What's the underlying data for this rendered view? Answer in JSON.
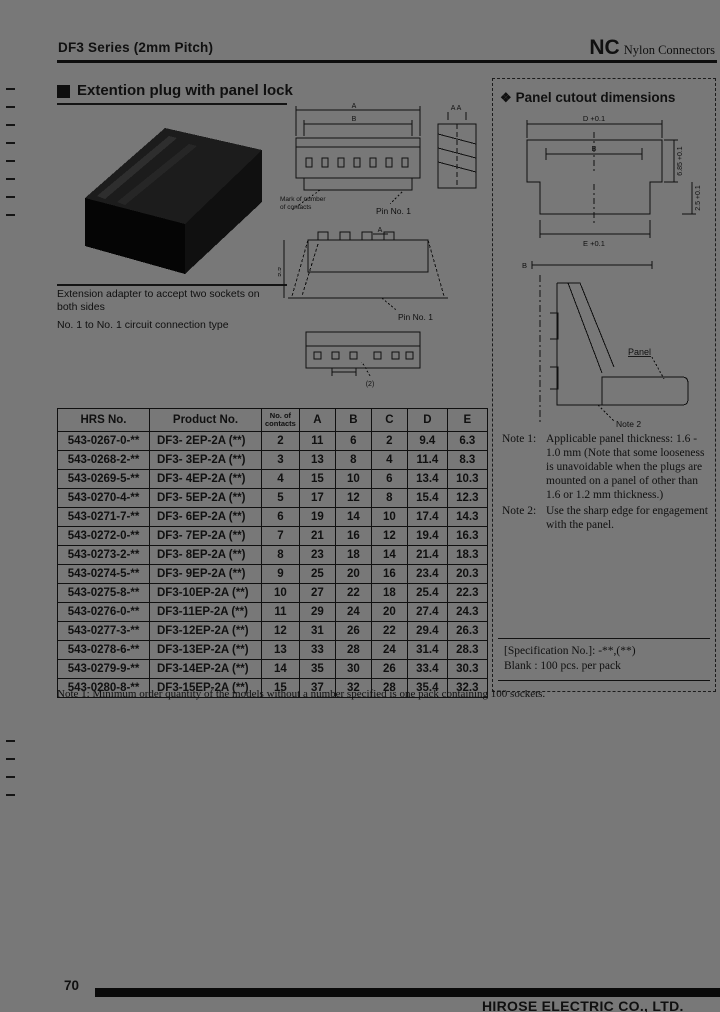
{
  "header": {
    "series": "DF3 Series (2mm Pitch)",
    "brand": "NC",
    "brand_type": "Nylon Connectors"
  },
  "plug_section": {
    "title": "Extention plug with panel lock",
    "caption1": "Extension adapter to accept two sockets on",
    "caption2": "both sides",
    "caption3": "No. 1 to No. 1 circuit connection type"
  },
  "drawings": {
    "dim_a_top": "A",
    "dim_b_top": "B",
    "section_label": "A  A",
    "mark_label1": "Mark of number",
    "mark_label2": "of contacts",
    "pin_label_front": "Pin No. 1",
    "dim_side_height": "9.9",
    "dim_side_a": "A",
    "pin_label_side": "Pin No. 1",
    "dim_bottom": "(2)"
  },
  "panel_section": {
    "bullet": "❖",
    "title": "Panel cutout dimensions",
    "cutout_dim_top": "D +0.1",
    "cutout_dim_inner": "B",
    "cutout_dim_right_upper": "6.85 +0.1",
    "cutout_dim_right_lower": "2.5 +0.1",
    "cutout_dim_bottom": "E +0.1",
    "engage_dim_top": "B",
    "panel_label": "Panel",
    "note2_ref": "Note 2",
    "note1_label": "Note 1:",
    "note1_text": "Applicable panel thickness: 1.6 - 1.0 mm (Note that some looseness is unavoidable when the plugs are mounted on a panel of other than 1.6 or 1.2 mm thickness.)",
    "note2_label": "Note 2:",
    "note2_text": "Use the sharp edge for engagement with the panel.",
    "spec_line1": "[Specification No.]: -**,(**)",
    "spec_line2": "Blank : 100 pcs. per pack"
  },
  "table": {
    "headers": [
      "HRS No.",
      "Product No.",
      "No. of contacts",
      "A",
      "B",
      "C",
      "D",
      "E"
    ],
    "rows": [
      [
        "543-0267-0-**",
        "DF3- 2EP-2A (**)",
        "2",
        "11",
        "6",
        "2",
        "9.4",
        "6.3"
      ],
      [
        "543-0268-2-**",
        "DF3- 3EP-2A (**)",
        "3",
        "13",
        "8",
        "4",
        "11.4",
        "8.3"
      ],
      [
        "543-0269-5-**",
        "DF3- 4EP-2A (**)",
        "4",
        "15",
        "10",
        "6",
        "13.4",
        "10.3"
      ],
      [
        "543-0270-4-**",
        "DF3- 5EP-2A (**)",
        "5",
        "17",
        "12",
        "8",
        "15.4",
        "12.3"
      ],
      [
        "543-0271-7-**",
        "DF3- 6EP-2A (**)",
        "6",
        "19",
        "14",
        "10",
        "17.4",
        "14.3"
      ],
      [
        "543-0272-0-**",
        "DF3- 7EP-2A (**)",
        "7",
        "21",
        "16",
        "12",
        "19.4",
        "16.3"
      ],
      [
        "543-0273-2-**",
        "DF3- 8EP-2A (**)",
        "8",
        "23",
        "18",
        "14",
        "21.4",
        "18.3"
      ],
      [
        "543-0274-5-**",
        "DF3- 9EP-2A (**)",
        "9",
        "25",
        "20",
        "16",
        "23.4",
        "20.3"
      ],
      [
        "543-0275-8-**",
        "DF3-10EP-2A (**)",
        "10",
        "27",
        "22",
        "18",
        "25.4",
        "22.3"
      ],
      [
        "543-0276-0-**",
        "DF3-11EP-2A (**)",
        "11",
        "29",
        "24",
        "20",
        "27.4",
        "24.3"
      ],
      [
        "543-0277-3-**",
        "DF3-12EP-2A (**)",
        "12",
        "31",
        "26",
        "22",
        "29.4",
        "26.3"
      ],
      [
        "543-0278-6-**",
        "DF3-13EP-2A (**)",
        "13",
        "33",
        "28",
        "24",
        "31.4",
        "28.3"
      ],
      [
        "543-0279-9-**",
        "DF3-14EP-2A (**)",
        "14",
        "35",
        "30",
        "26",
        "33.4",
        "30.3"
      ],
      [
        "543-0280-8-**",
        "DF3-15EP-2A (**)",
        "15",
        "37",
        "32",
        "28",
        "35.4",
        "32.3"
      ]
    ]
  },
  "table_note": "Note 1: Minimum order quantity of the models without a number specified is one pack containing 100 sockets.",
  "footer": {
    "page_number": "70",
    "company": "HIROSE ELECTRIC CO., LTD."
  }
}
